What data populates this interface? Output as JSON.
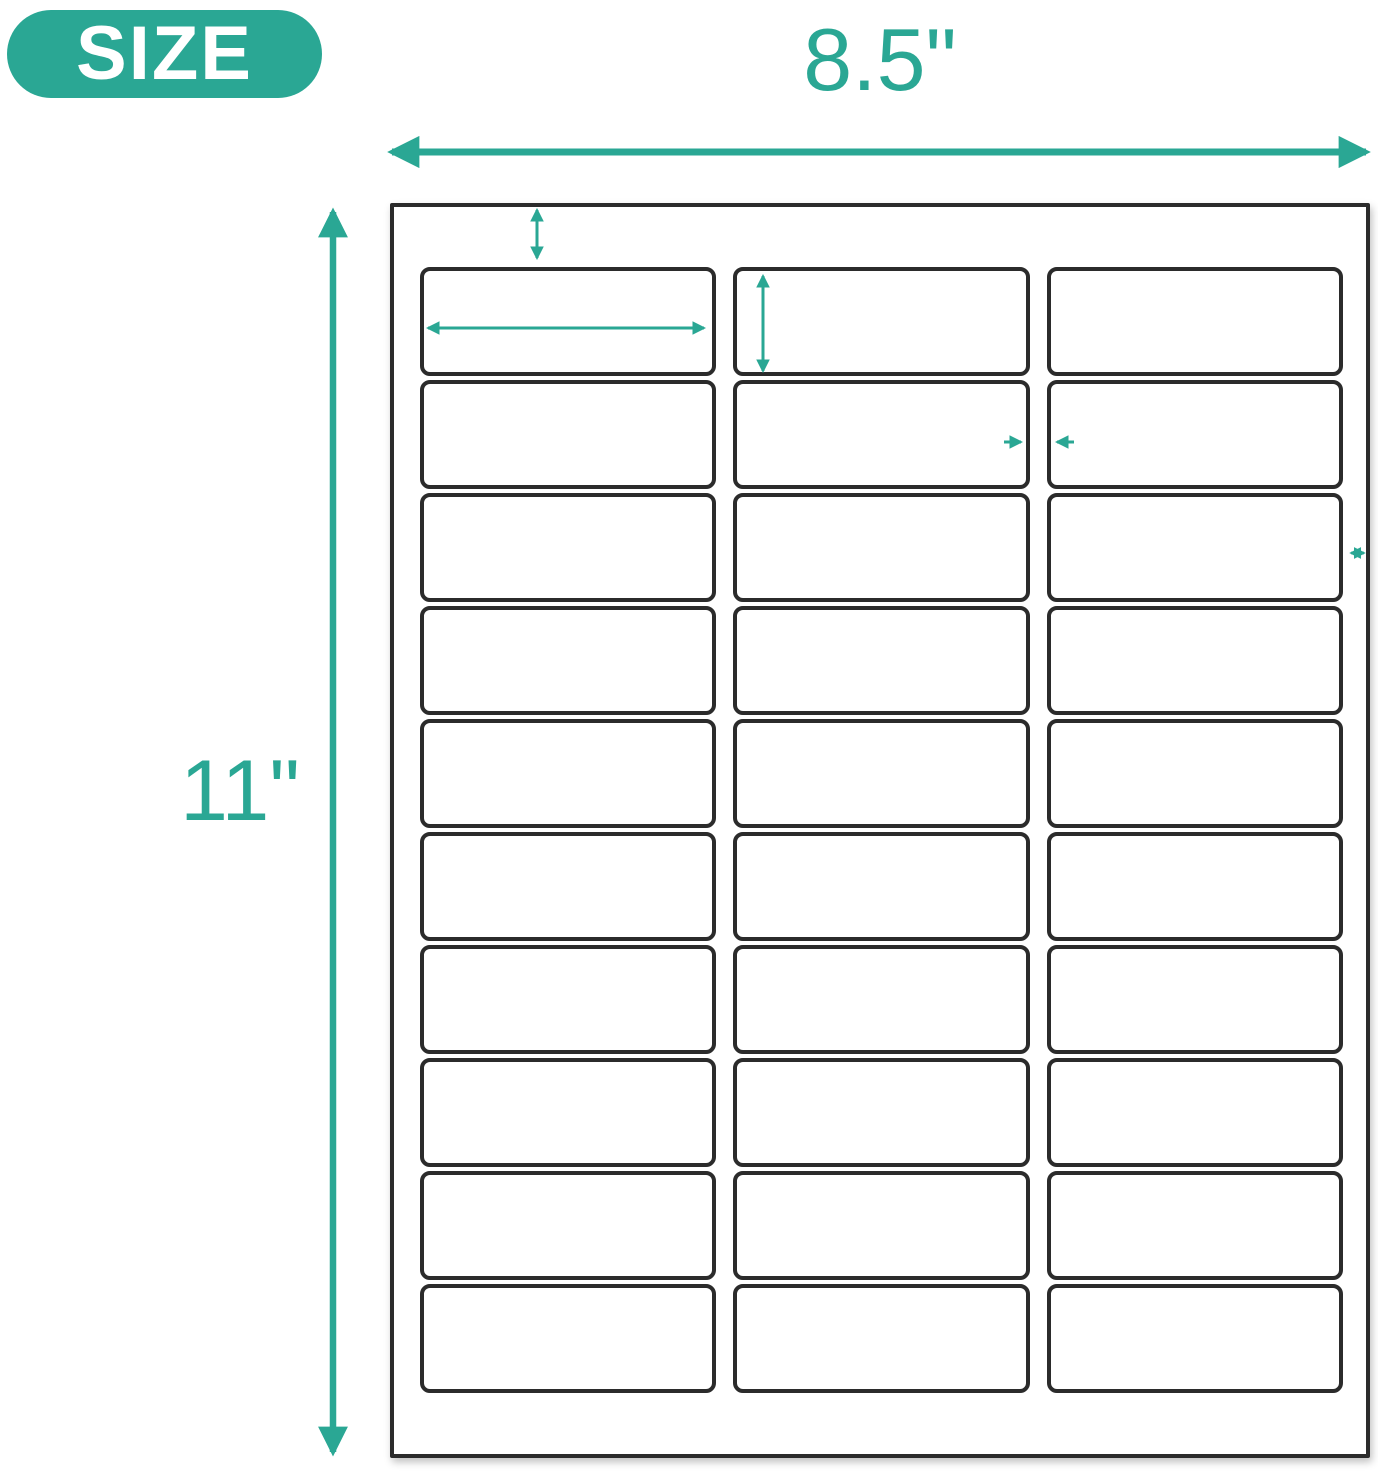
{
  "badge": {
    "label": "SIZE"
  },
  "colors": {
    "accent": "#2AA794",
    "label_border": "#2B2B2B",
    "sheet_bg": "#FFFFFF",
    "badge_text": "#FFFFFF"
  },
  "sheet": {
    "rows": 10,
    "cols": 3
  },
  "dimensions": {
    "sheet_width": "8.5\"",
    "sheet_height": "11\"",
    "top_margin": "0.5\"",
    "label_width": "2.625\"",
    "label_height": "1.024\"",
    "column_gap": "0.126\"",
    "right_margin": "0.197\""
  },
  "icons": {
    "sheet_width_arrow": "horizontal-double-arrow",
    "sheet_height_arrow": "vertical-double-arrow",
    "top_margin_arrow": "vertical-double-arrow",
    "label_width_arrow": "horizontal-double-arrow",
    "label_height_arrow": "vertical-double-arrow",
    "column_gap_right_arrow": "right-arrow",
    "column_gap_left_arrow": "left-arrow",
    "right_margin_arrow": "horizontal-double-arrow"
  }
}
